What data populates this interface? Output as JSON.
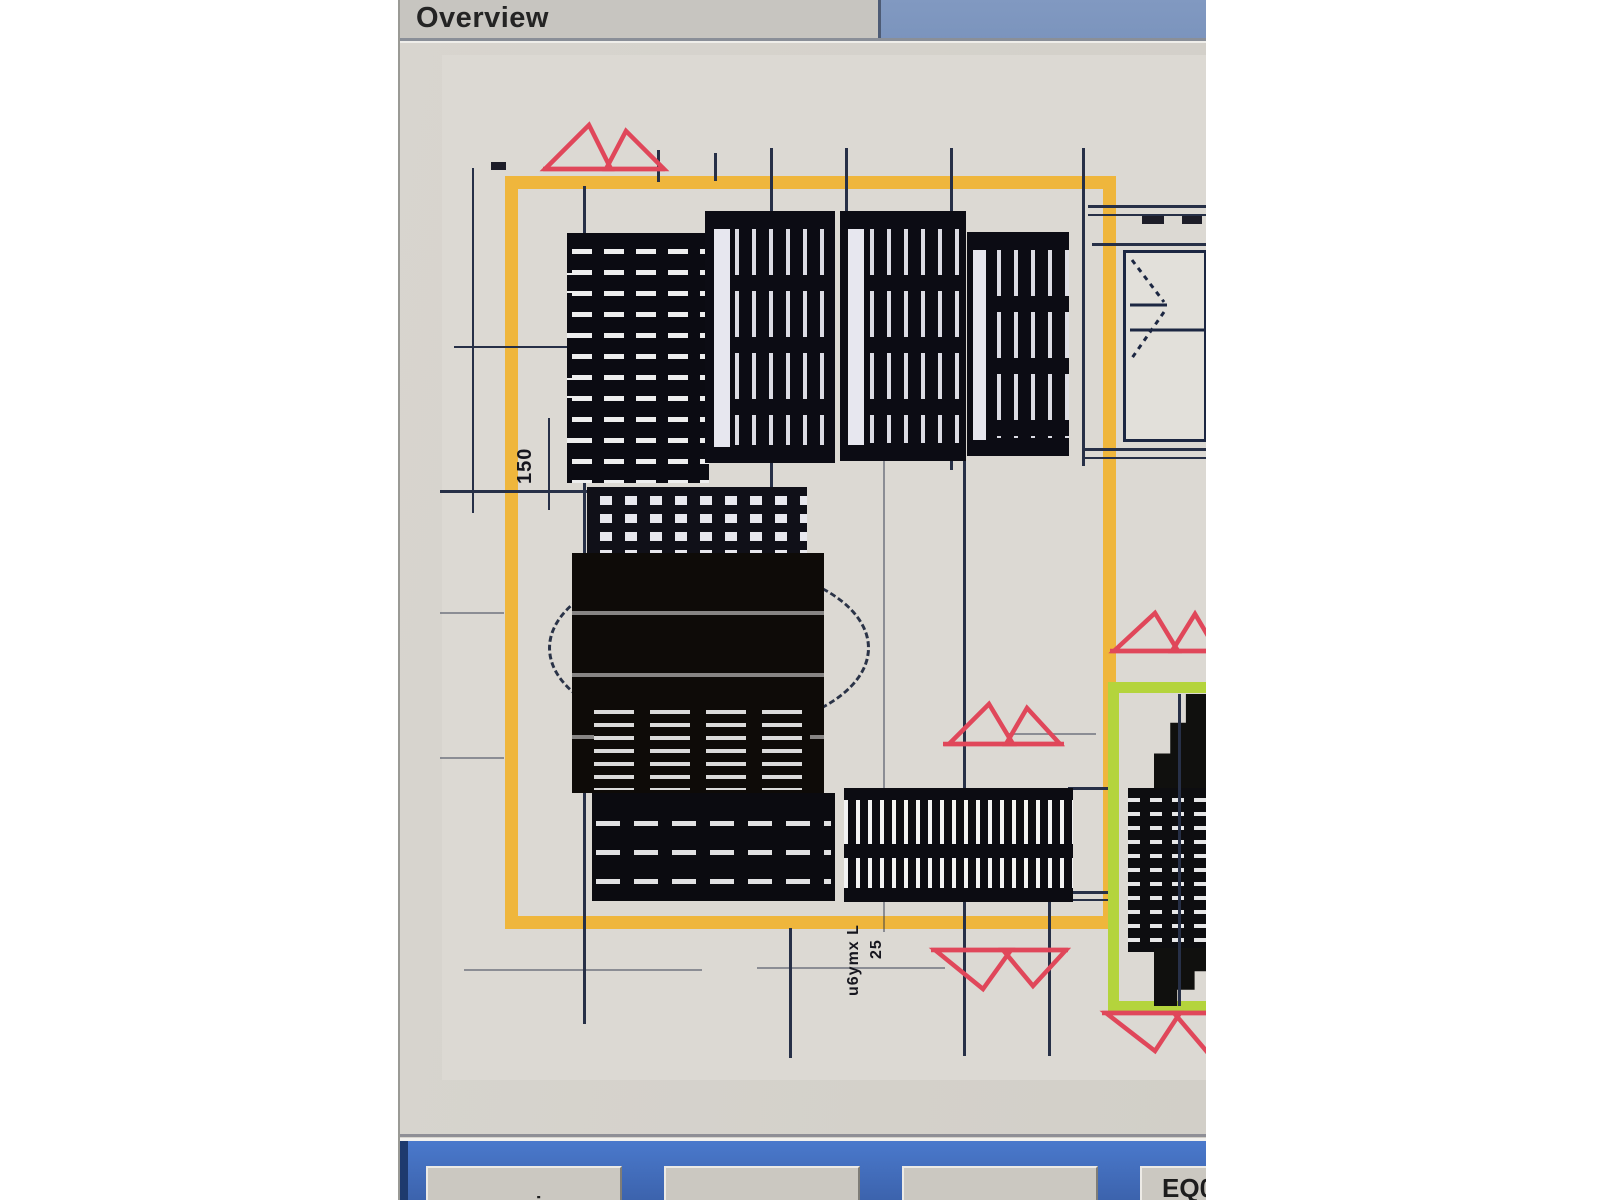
{
  "window": {
    "title": "Overview"
  },
  "drawing": {
    "dim_label_vertical": "150",
    "dim_label_bottom": "25",
    "part_label_bottom": "u6ymx L",
    "colors": {
      "highlight_orange": "#EFB63C",
      "highlight_green": "#B4D43C",
      "marker_red": "#E0475A",
      "line_dark": "#273047"
    }
  },
  "bottom_bar": {
    "buttons": [
      {
        "label": "overview"
      },
      {
        "label": ""
      },
      {
        "label": ""
      },
      {
        "label": "EQ0"
      }
    ]
  }
}
